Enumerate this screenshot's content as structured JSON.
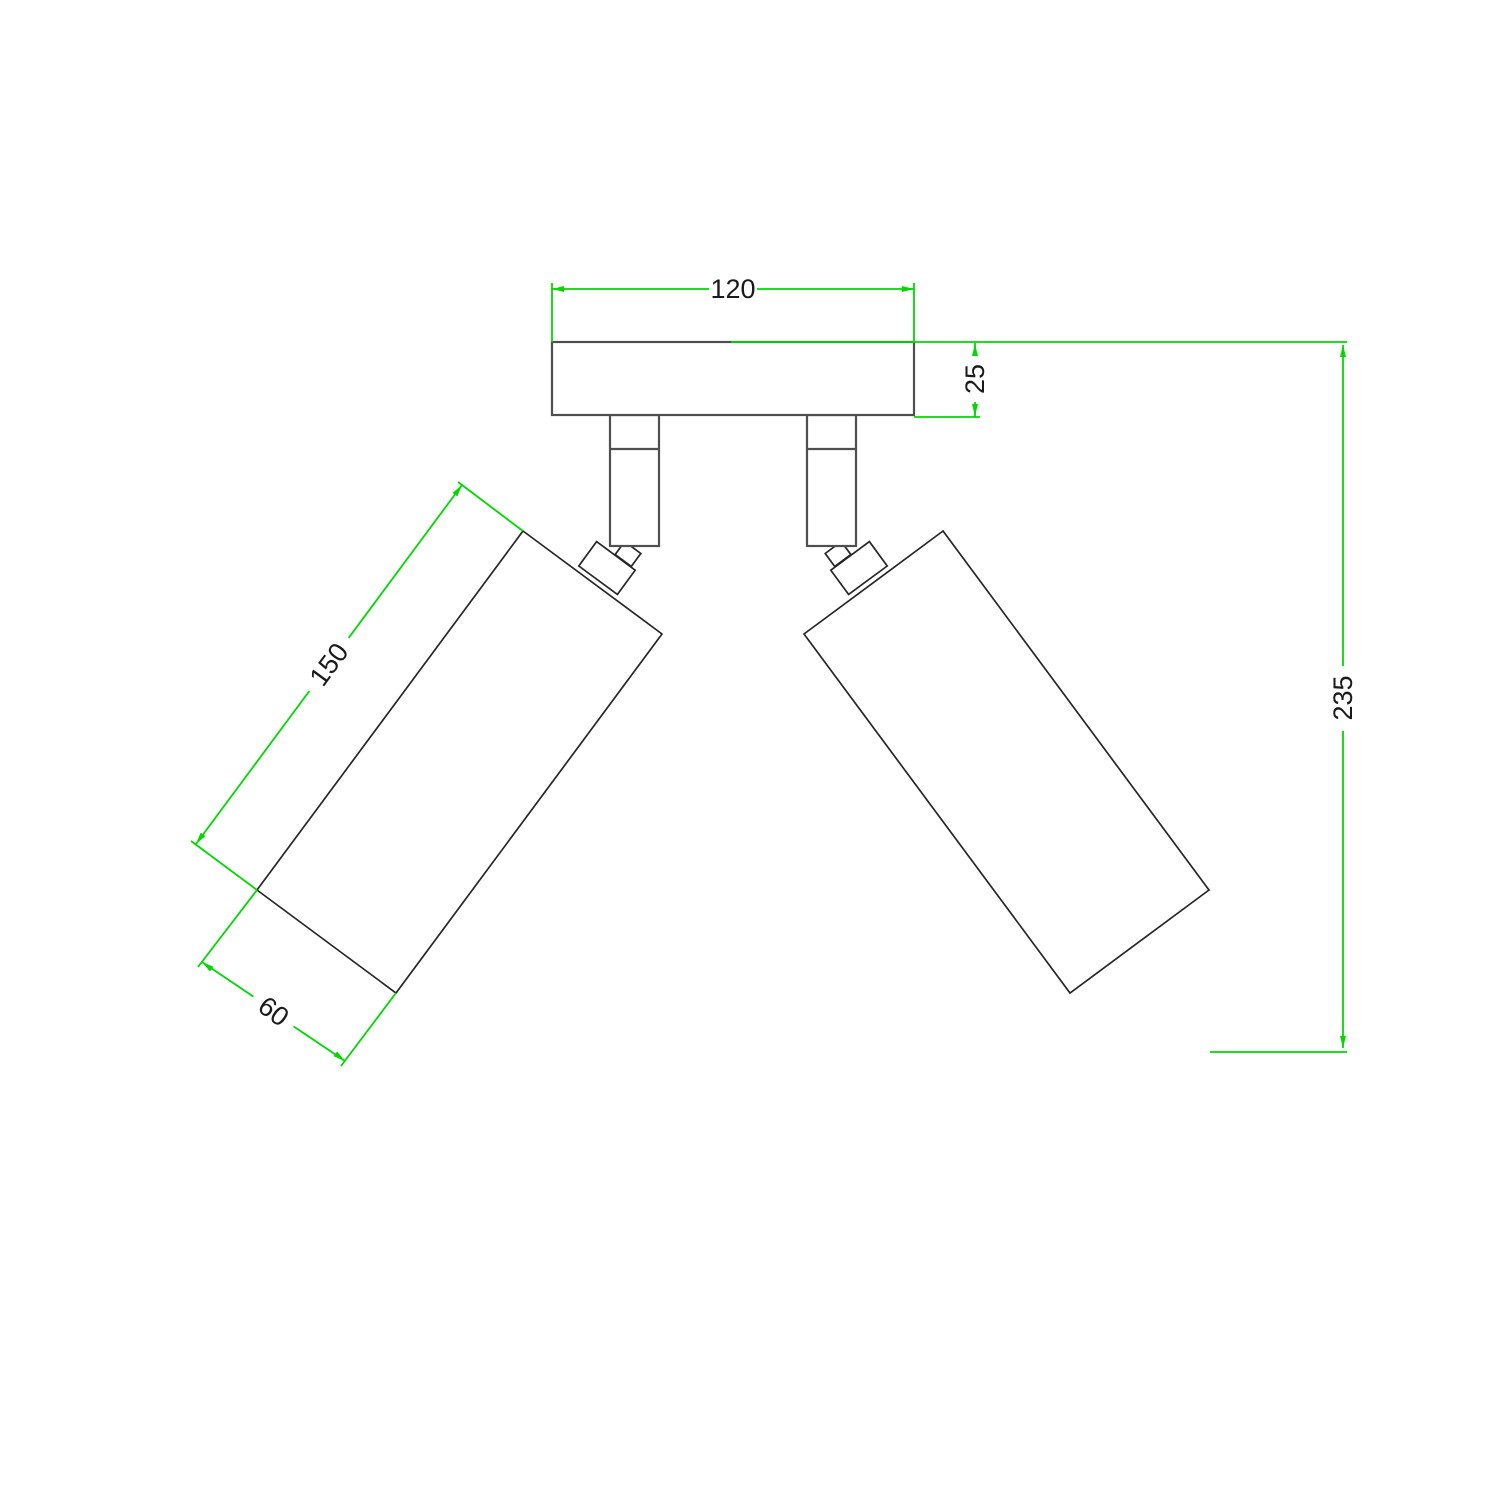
{
  "diagram": {
    "canvas": {
      "width": 1500,
      "height": 1500,
      "background": "#ffffff"
    },
    "colors": {
      "dimension_green": "#00d800",
      "outline_gray": "#4f4f4f",
      "outline_dark": "#262626",
      "label_text": "#1a1a1a",
      "fill_white": "#ffffff"
    },
    "stroke_widths": {
      "dimension": 1.8,
      "gray": 2.2,
      "dark": 1.7
    },
    "label_font_size": 27,
    "arrow": {
      "length": 12,
      "half_width": 3
    },
    "parts": [
      {
        "name": "left-spotlight-body",
        "type": "polygon",
        "stroke": "dark",
        "points": [
          [
            523,
            531
          ],
          [
            662,
            634
          ],
          [
            396,
            993
          ],
          [
            257,
            890
          ]
        ]
      },
      {
        "name": "right-spotlight-body",
        "type": "polygon",
        "stroke": "dark",
        "points": [
          [
            943,
            531
          ],
          [
            804,
            634
          ],
          [
            1070,
            993
          ],
          [
            1209,
            890
          ]
        ]
      },
      {
        "name": "left-knuckle",
        "type": "polygon",
        "stroke": "dark",
        "points": [
          [
            596.6,
            541.6
          ],
          [
            635.2,
            570.2
          ],
          [
            617.4,
            594.4
          ],
          [
            578.8,
            566.0
          ]
        ]
      },
      {
        "name": "right-knuckle",
        "type": "polygon",
        "stroke": "dark",
        "points": [
          [
            869.4,
            541.6
          ],
          [
            830.8,
            570.2
          ],
          [
            848.6,
            594.4
          ],
          [
            887.2,
            566.0
          ]
        ]
      },
      {
        "name": "left-neck",
        "type": "polygon",
        "stroke": "dark",
        "points": [
          [
            624.7,
            541.6
          ],
          [
            640.8,
            553.5
          ],
          [
            631.3,
            566.4
          ],
          [
            615.2,
            554.5
          ]
        ]
      },
      {
        "name": "right-neck",
        "type": "polygon",
        "stroke": "dark",
        "points": [
          [
            841.3,
            541.6
          ],
          [
            825.2,
            553.5
          ],
          [
            834.7,
            566.4
          ],
          [
            850.8,
            554.5
          ]
        ]
      },
      {
        "name": "left-stem",
        "type": "rect",
        "stroke": "gray",
        "x": 610,
        "y": 415,
        "w": 49,
        "h": 131
      },
      {
        "name": "right-stem",
        "type": "rect",
        "stroke": "gray",
        "x": 807,
        "y": 415,
        "w": 49,
        "h": 131
      },
      {
        "name": "left-stem-divider",
        "type": "line",
        "stroke": "gray",
        "x1": 610,
        "y1": 449,
        "x2": 659,
        "y2": 449
      },
      {
        "name": "right-stem-divider",
        "type": "line",
        "stroke": "gray",
        "x1": 807,
        "y1": 449,
        "x2": 856,
        "y2": 449
      },
      {
        "name": "mounting-plate",
        "type": "rect",
        "stroke": "gray",
        "x": 552,
        "y": 342,
        "w": 362,
        "h": 73
      }
    ],
    "dims": {
      "plate_width": {
        "label": "120",
        "ext": [
          [
            552,
            283,
            552,
            342
          ],
          [
            914,
            283,
            914,
            342
          ]
        ],
        "segs": [
          [
            552,
            289,
            709,
            289
          ],
          [
            757,
            289,
            914,
            289
          ]
        ],
        "arrows": [
          {
            "tip": [
              552,
              289
            ],
            "dir": [
              -1,
              0
            ]
          },
          {
            "tip": [
              914,
              289
            ],
            "dir": [
              1,
              0
            ]
          }
        ],
        "text": {
          "pos": [
            733,
            289
          ],
          "rot": 0
        }
      },
      "plate_thickness": {
        "label": "25",
        "ext": [
          [
            731,
            342,
            1347,
            342
          ],
          [
            914,
            417,
            980,
            417
          ]
        ],
        "segs": [
          [
            975,
            343,
            975,
            356
          ],
          [
            975,
            402,
            975,
            417
          ]
        ],
        "arrows": [
          {
            "tip": [
              975,
              344
            ],
            "dir": [
              0,
              -1
            ]
          },
          {
            "tip": [
              975,
              416
            ],
            "dir": [
              0,
              1
            ]
          }
        ],
        "text": {
          "pos": [
            975,
            379
          ],
          "rot": -90
        }
      },
      "overall_height": {
        "label": "235",
        "ext": [
          [
            1210,
            1052,
            1347,
            1052
          ]
        ],
        "segs": [
          [
            1343,
            345,
            1343,
            666
          ],
          [
            1343,
            731,
            1343,
            1048
          ]
        ],
        "arrows": [
          {
            "tip": [
              1343,
              345
            ],
            "dir": [
              0,
              -1
            ]
          },
          {
            "tip": [
              1343,
              1048
            ],
            "dir": [
              0,
              1
            ]
          }
        ],
        "text": {
          "pos": [
            1343,
            698
          ],
          "rot": -90
        }
      },
      "spotlight_length": {
        "label": "150",
        "ext": [
          [
            523,
            531,
            458,
            482
          ],
          [
            257,
            890,
            191,
            841
          ]
        ],
        "segs": [
          [
            462,
            485,
            348.6,
            638
          ],
          [
            309.4,
            691,
            196,
            844
          ]
        ],
        "arrows": [
          {
            "tip": [
              462,
              485
            ],
            "dir": [
              0.595,
              -0.803
            ]
          },
          {
            "tip": [
              196,
              844
            ],
            "dir": [
              -0.595,
              0.803
            ]
          }
        ],
        "text": {
          "pos": [
            329,
            664.5
          ],
          "rot": -53.5
        }
      },
      "spotlight_diameter": {
        "label": "60",
        "ext": [
          [
            257,
            890,
            198,
            967
          ],
          [
            396,
            993,
            341,
            1066
          ]
        ],
        "segs": [
          [
            202,
            962,
            253.4,
            996.6
          ],
          [
            293.6,
            1026.4,
            345,
            1061
          ]
        ],
        "arrows": [
          {
            "tip": [
              202,
              962
            ],
            "dir": [
              -0.803,
              -0.595
            ]
          },
          {
            "tip": [
              345,
              1061
            ],
            "dir": [
              0.803,
              0.595
            ]
          }
        ],
        "text": {
          "pos": [
            273.5,
            1011.5
          ],
          "rot": 36.5
        }
      }
    }
  }
}
